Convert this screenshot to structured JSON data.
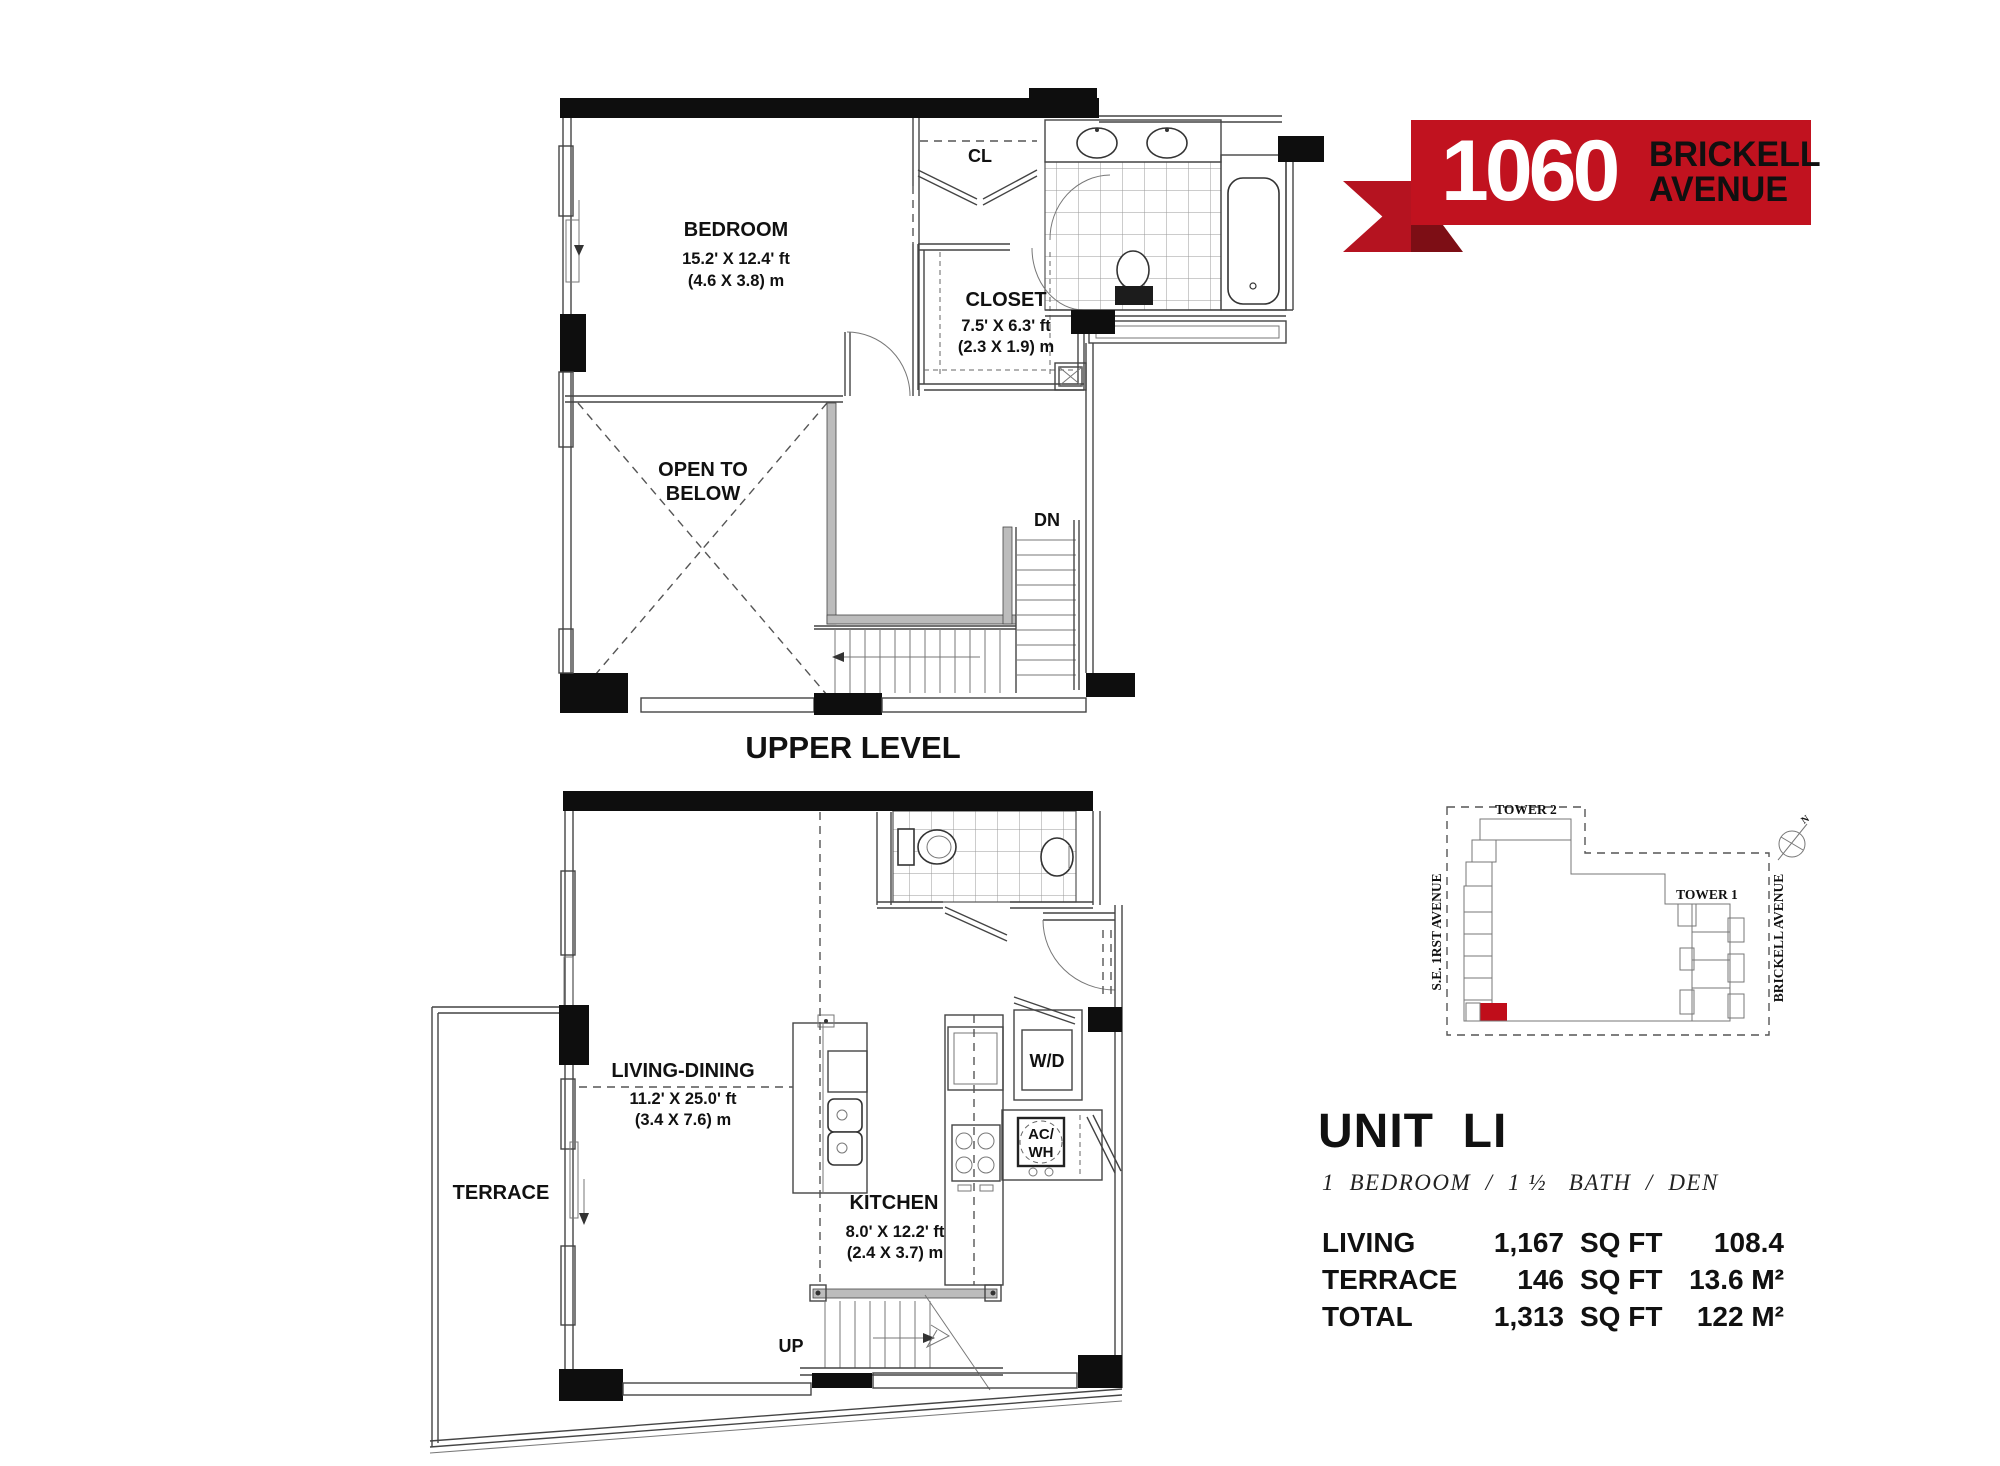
{
  "logo": {
    "number": "1060",
    "line1": "BRICKELL",
    "line2": "AVENUE"
  },
  "colors": {
    "banner_red": "#c1121f",
    "ribbon_fold_red": "#7d0e15",
    "site_unit_red": "#c00d1a",
    "wall_black": "#0e0e0e"
  },
  "upper_plan": {
    "title": "UPPER LEVEL",
    "bedroom": {
      "name": "BEDROOM",
      "dim_ft": "15.2' X 12.4' ft",
      "dim_m": "(4.6 X 3.8) m"
    },
    "cl": {
      "label": "CL"
    },
    "closet": {
      "name": "CLOSET",
      "dim_ft": "7.5' X 6.3' ft",
      "dim_m": "(2.3 X 1.9) m"
    },
    "open_below": {
      "line1": "OPEN TO",
      "line2": "BELOW"
    },
    "stairs_label": "DN"
  },
  "lower_plan": {
    "terrace": {
      "label": "TERRACE"
    },
    "living": {
      "name": "LIVING-DINING",
      "dim_ft": "11.2' X 25.0' ft",
      "dim_m": "(3.4 X 7.6) m"
    },
    "kitchen": {
      "name": "KITCHEN",
      "dim_ft": "8.0' X 12.2' ft",
      "dim_m": "(2.4 X 3.7) m"
    },
    "wd_label": "W/D",
    "ac_label_line1": "AC/",
    "ac_label_line2": "WH",
    "stairs_label": "UP"
  },
  "site_plan": {
    "tower2_label": "TOWER 2",
    "tower1_label": "TOWER 1",
    "street_left": "S.E. 1RST AVENUE",
    "street_right": "BRICKELL AVENUE",
    "north_label": "N"
  },
  "unit_info": {
    "title": "UNIT  LI",
    "subtitle": "1  BEDROOM  /  1 ½   BATH  /  DEN",
    "rows": [
      {
        "label": "LIVING",
        "sqft": "1,167",
        "sqft_unit": "SQ FT",
        "m2": "108.4 M²"
      },
      {
        "label": "TERRACE",
        "sqft": "146",
        "sqft_unit": "SQ FT",
        "m2": "13.6 M²"
      },
      {
        "label": "TOTAL",
        "sqft": "1,313",
        "sqft_unit": "SQ FT",
        "m2": "122 M²"
      }
    ]
  }
}
